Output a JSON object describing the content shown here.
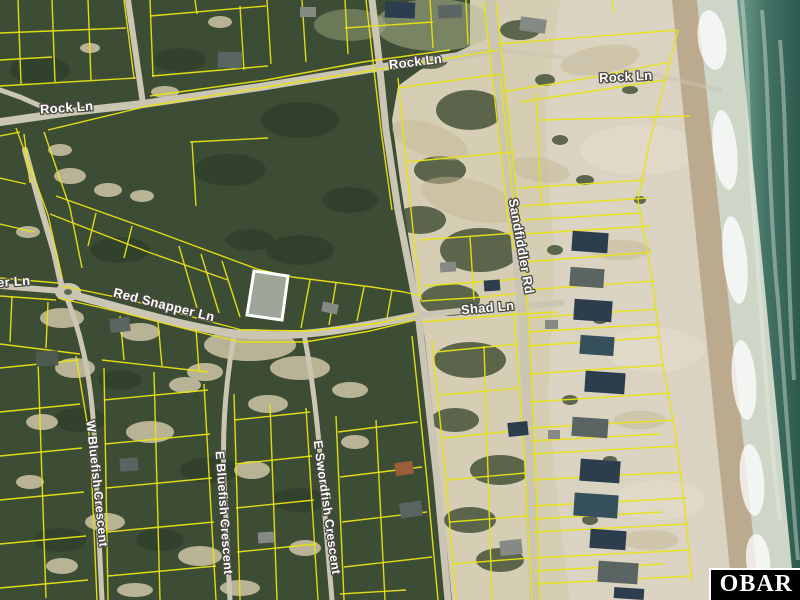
{
  "map": {
    "type": "aerial-parcel-map",
    "labels": [
      {
        "text": "Rock Ln",
        "x": 67,
        "y": 112,
        "rotation": -4,
        "size": 13
      },
      {
        "text": "Rock Ln",
        "x": 416,
        "y": 66,
        "rotation": -7,
        "size": 13
      },
      {
        "text": "Rock Ln",
        "x": 626,
        "y": 81,
        "rotation": -3,
        "size": 13
      },
      {
        "text": "er Ln",
        "x": 14,
        "y": 286,
        "rotation": -4,
        "size": 13
      },
      {
        "text": "Red Snapper Ln",
        "x": 163,
        "y": 309,
        "rotation": 14,
        "size": 13
      },
      {
        "text": "Shad Ln",
        "x": 488,
        "y": 312,
        "rotation": -5,
        "size": 13
      },
      {
        "text": "Sandfiddler Rd",
        "x": 517,
        "y": 247,
        "rotation": 80,
        "size": 13
      },
      {
        "text": "W Bluefish Crescent",
        "x": 93,
        "y": 484,
        "rotation": 84,
        "size": 12.5
      },
      {
        "text": "E Bluefish Crescent",
        "x": 220,
        "y": 513,
        "rotation": 86,
        "size": 12.5
      },
      {
        "text": "E Swordfish Crescent",
        "x": 323,
        "y": 508,
        "rotation": 82,
        "size": 12.5
      }
    ],
    "subject_parcel": {
      "points": "254,271 288,276 282,320 247,315",
      "stroke": "#ffffff",
      "fill": "rgba(255,255,255,0.5)"
    },
    "palette": {
      "parcel_line": "#e8e312",
      "vegetation": "#3d4d35",
      "vegetation_dark": "#2c3a26",
      "sand": "#d5cdb4",
      "beach": "#dcd5c4",
      "wet_sand": "#b5a285",
      "foam": "#ccd6c9",
      "ocean": "#3f7264",
      "road": "#cbc5b3",
      "label_fill": "#ffffff",
      "label_halo": "#4a4a42",
      "subject_highlight": "#ffffff"
    }
  },
  "watermark": {
    "text": "OBAR",
    "background": "#000000",
    "color": "#ffffff"
  }
}
